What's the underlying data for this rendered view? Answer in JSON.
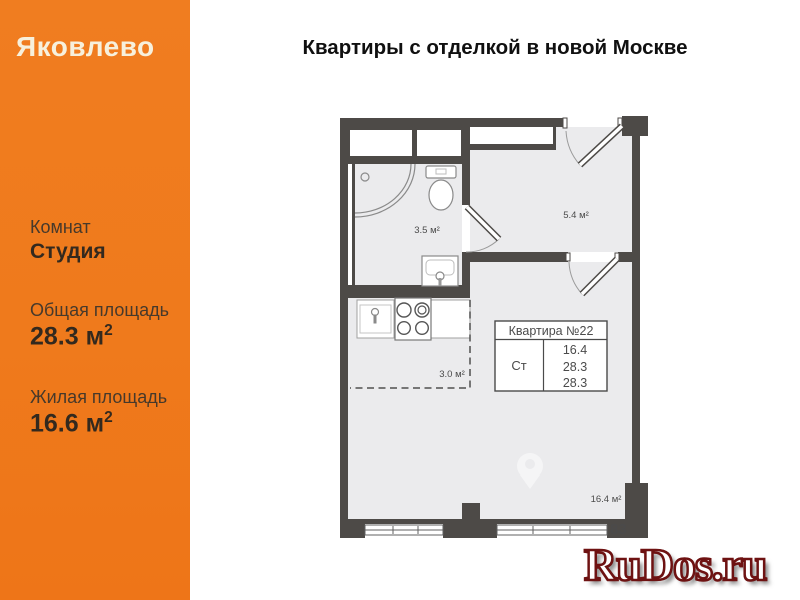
{
  "brand": {
    "logo": "Яковлево",
    "accent_color": "#ef7a1c"
  },
  "header": {
    "title": "Квартиры с отделкой в новой Москве"
  },
  "sidebar": {
    "rooms": {
      "label": "Комнат",
      "value": "Студия"
    },
    "total_area": {
      "label": "Общая площадь",
      "value": "28.3 м",
      "sup": "2"
    },
    "living_area": {
      "label": "Жилая площадь",
      "value": "16.6 м",
      "sup": "2"
    }
  },
  "floorplan": {
    "wall_color": "#4d4a47",
    "floor_color": "#ebebed",
    "labels": {
      "bathroom": "3.5 м²",
      "hallway": "5.4 м²",
      "kitchen": "3.0 м²",
      "living_room": "16.4 м²"
    },
    "info_table": {
      "title": "Квартира №22",
      "type": "Ст",
      "areas": [
        "16.4",
        "28.3",
        "28.3"
      ]
    }
  },
  "watermarks": {
    "site": "RuDos.ru",
    "digits": "83"
  }
}
